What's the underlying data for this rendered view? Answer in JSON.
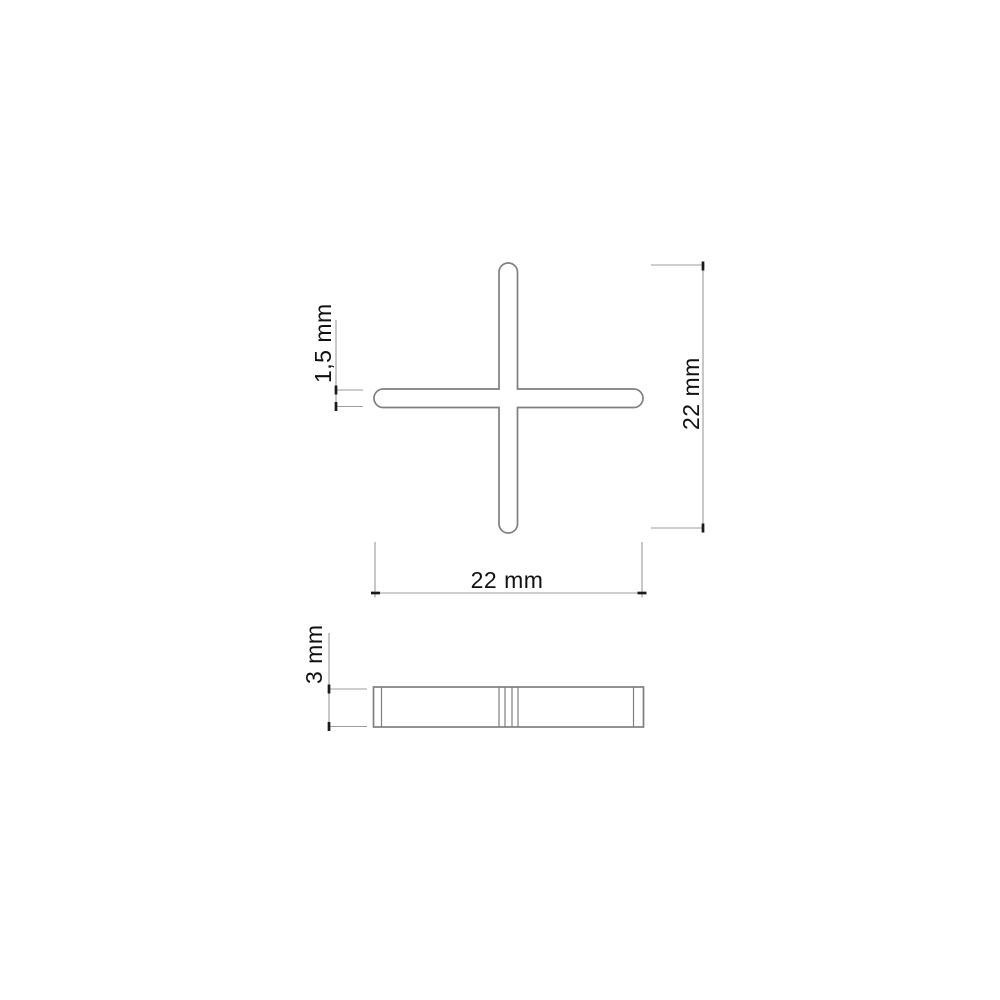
{
  "drawing": {
    "product": "cross tile spacer",
    "kind": "dimensioned technical drawing",
    "views": {
      "top": {
        "name": "top view",
        "shape": "cross with rounded arm ends"
      },
      "side": {
        "name": "side view",
        "shape": "flat bar"
      }
    },
    "dimensions": {
      "arm_thickness": {
        "label": "1,5 mm",
        "value_mm": 1.5,
        "applies_to": "joint width of cross arm"
      },
      "overall_height": {
        "label": "22 mm",
        "value_mm": 22,
        "applies_to": "overall height of cross"
      },
      "overall_width": {
        "label": "22 mm",
        "value_mm": 22,
        "applies_to": "overall width of cross"
      },
      "thickness": {
        "label": "3 mm",
        "value_mm": 3,
        "applies_to": "spacer thickness (side view)"
      }
    },
    "colors": {
      "background": "#ffffff",
      "outline": "#7f7f7f",
      "dimension_line": "#9c9c9c",
      "tick": "#1a1a1a",
      "label_text": "#111111"
    }
  }
}
